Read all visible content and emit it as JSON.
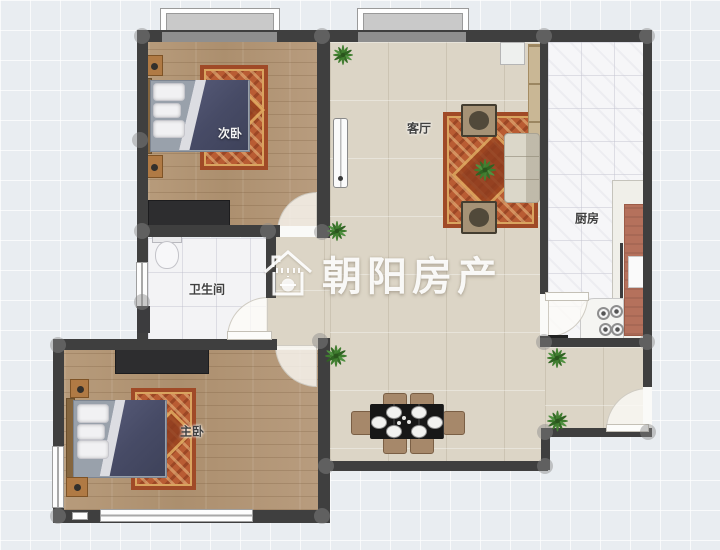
{
  "view": {
    "type": "floorplan",
    "width": 720,
    "height": 550
  },
  "watermark": {
    "brand": "朝阳房产",
    "icon": "house-sun-icon"
  },
  "rooms": [
    {
      "id": "secondary-bedroom",
      "label": "次卧"
    },
    {
      "id": "living-room",
      "label": "客厅"
    },
    {
      "id": "kitchen",
      "label": "厨房"
    },
    {
      "id": "bathroom",
      "label": "卫生间"
    },
    {
      "id": "master-bedroom",
      "label": "主卧"
    }
  ],
  "colors": {
    "background": "#e9edf1",
    "wall": "#3f3f3f",
    "wood_floor": "#b59878",
    "living_tile": "#dcd5c6",
    "bath_tile": "#f3f3f5",
    "kitchen_tile": "#f6f6f8",
    "rug": "#b95c33",
    "duvet": "#4b4f6b",
    "plant": "#3e7d2e",
    "counter": "#b5715c",
    "watermark": "#ffffff"
  }
}
